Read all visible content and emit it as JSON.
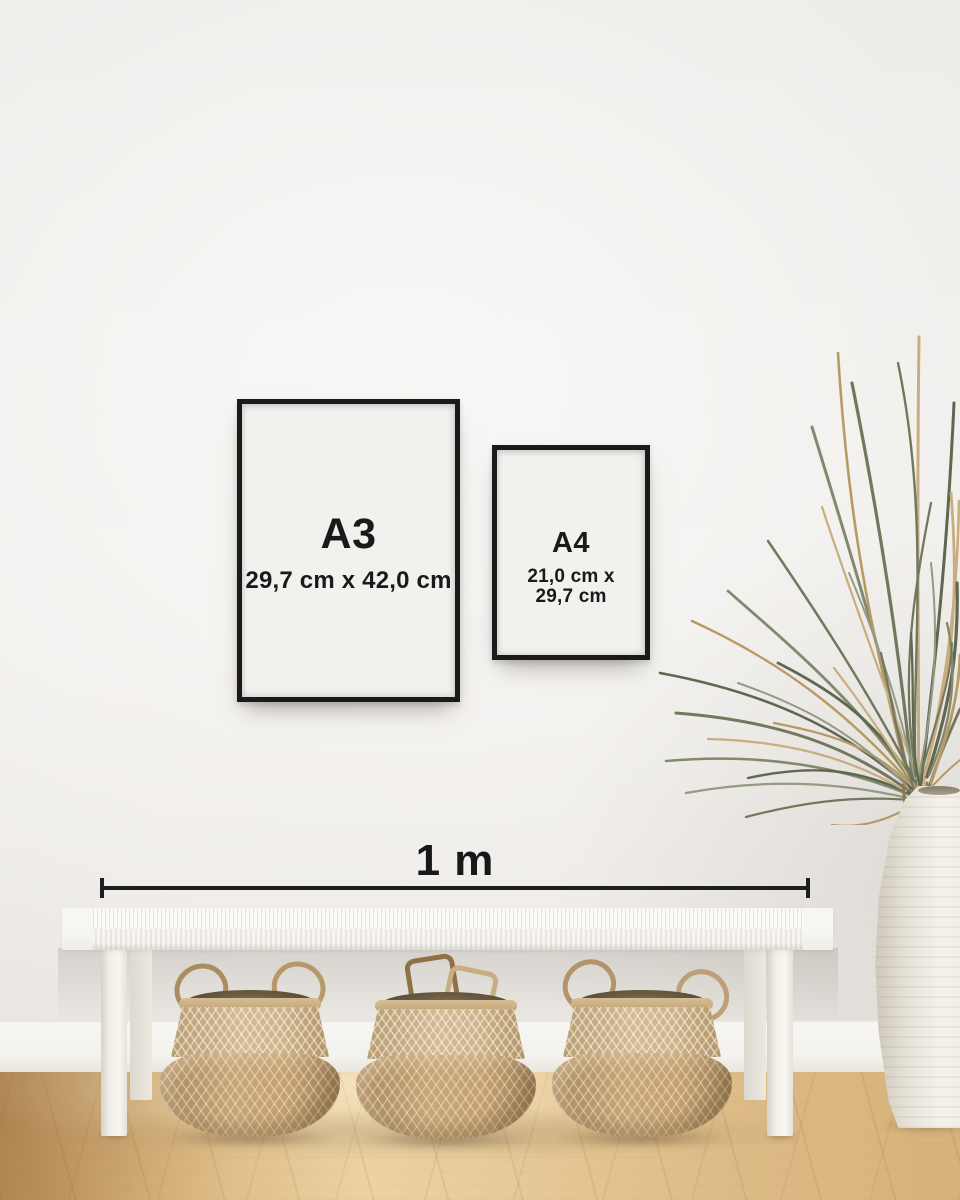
{
  "posters": {
    "a3": {
      "label": "A3",
      "dimensions": "29,7 cm x 42,0 cm"
    },
    "a4": {
      "label": "A4",
      "dimensions_line1": "21,0 cm x",
      "dimensions_line2": "29,7 cm"
    }
  },
  "scale": {
    "label": "1 m"
  },
  "colors": {
    "frame_black": "#191a1c",
    "text": "#191a1b",
    "wall": "#f1efec",
    "poster_paper": "#f2f1ee",
    "floor_wood": "#dcb984",
    "basket_wicker": "#c2a176",
    "bench_white": "#f3f1ec",
    "plant_green": "#6d7458",
    "plant_dried": "#b5975f",
    "vase_white": "#efece6"
  }
}
